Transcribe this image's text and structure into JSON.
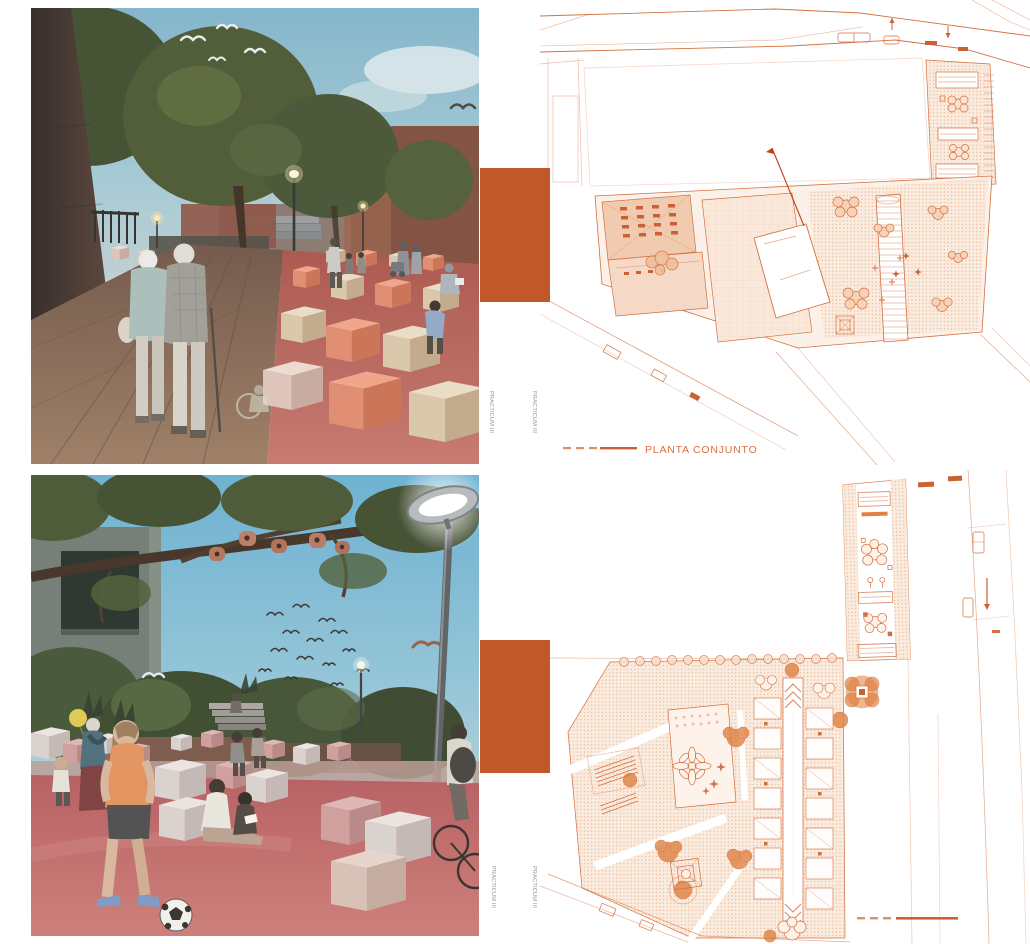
{
  "board": {
    "vertical_label": "PRACTICUM III",
    "plan_top_caption": "PLANTA CONJUNTO",
    "colors": {
      "accent_orange": "#C1582A",
      "plan_line": "#D4703F",
      "caption_text": "#DE6E3C",
      "vertical_label_text": "#8F9394",
      "background": "#FFFFFF"
    },
    "panels": {
      "top_left": {
        "type": "rendering",
        "alt": "plaza promenade rendering with elderly couple walking, trees, birds, coloured seating cubes"
      },
      "top_right": {
        "type": "site-plan",
        "caption": "PLANTA CONJUNTO"
      },
      "bottom_left": {
        "type": "rendering",
        "alt": "plaza playground rendering with girl playing football, street lamp, cubes, tree branch"
      },
      "bottom_right": {
        "type": "site-plan",
        "caption": ""
      }
    }
  }
}
